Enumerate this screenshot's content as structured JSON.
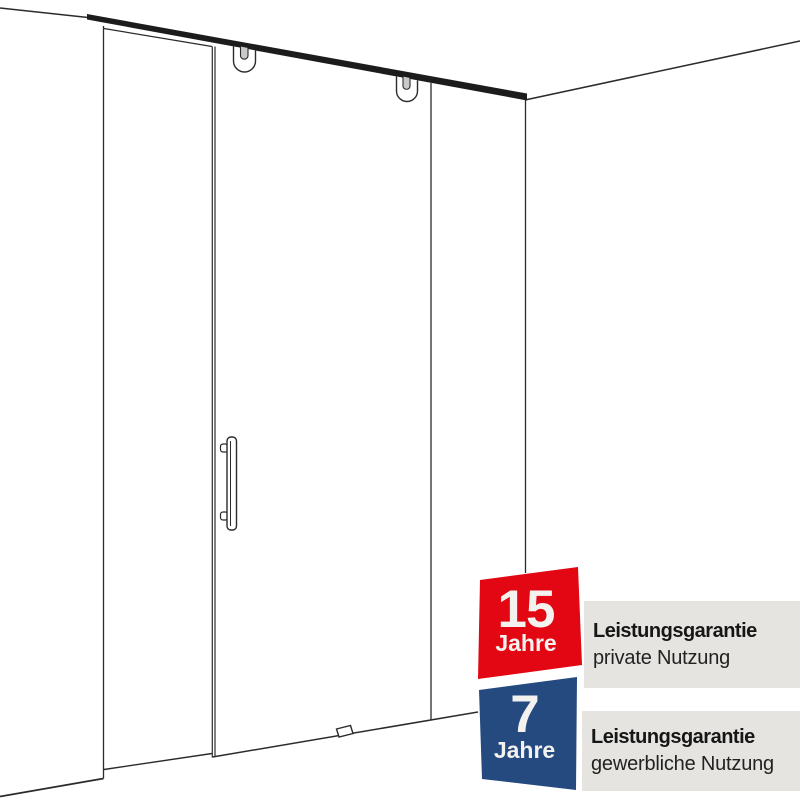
{
  "diagram": {
    "parts": [
      "left-wall",
      "back-wall-corner",
      "right-wall",
      "top-rail",
      "roller-hanger-left",
      "roller-hanger-right",
      "side-panel",
      "sliding-glass-door",
      "door-handle-bar",
      "floor-guide"
    ],
    "line_color": "#2b2b2b"
  },
  "warranty_badges": [
    {
      "value": "15",
      "unit": "Jahre",
      "title": "Leistungsgarantie",
      "subtitle": "private Nutzung",
      "badge_color": "#e30613"
    },
    {
      "value": "7",
      "unit": "Jahre",
      "title": "Leistungsgarantie",
      "subtitle": "gewerbliche Nutzung",
      "badge_color": "#254a80"
    }
  ],
  "colors": {
    "background": "#ffffff",
    "info_box": "#e5e4e0",
    "badge_text": "#f4f2ee",
    "rail_fill": "#1c1c1c",
    "roller_slot_fill": "#c9c9c9"
  }
}
